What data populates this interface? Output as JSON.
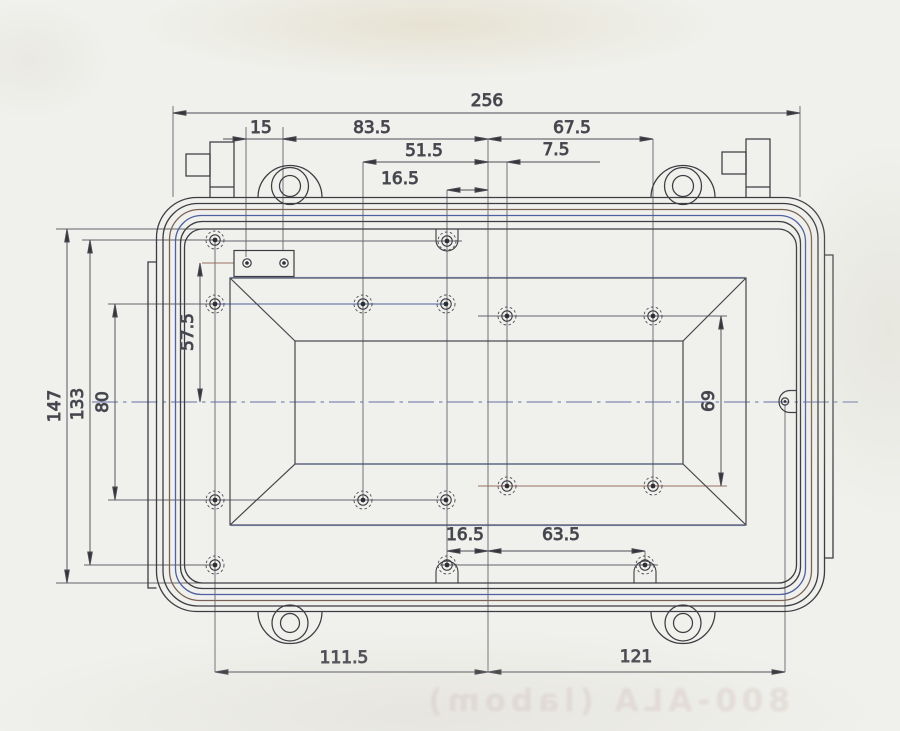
{
  "drawing": {
    "kind": "scanned engineering drawing",
    "view": "enclosure lid plan view",
    "units_implied": "mm"
  },
  "dimensions": {
    "overall_width": "256",
    "offset_15": "15",
    "span_83_5": "83.5",
    "span_67_5": "67.5",
    "span_51_5": "51.5",
    "offset_7_5": "7.5",
    "offset_16_5_top": "16.5",
    "height_147": "147",
    "height_133": "133",
    "height_80": "80",
    "height_57_5": "57.5",
    "height_69": "69",
    "offset_16_5_bottom": "16.5",
    "span_63_5": "63.5",
    "span_111_5": "111.5",
    "span_121": "121"
  },
  "bleed_through_text": "800-ALA (labom)",
  "colors": {
    "paper": "#f0f1ed",
    "ink": "#3c3c42",
    "dimension_ink": "#4d4d55",
    "construction_gray": "#63636b",
    "scan_tint_blue": "#5060a0",
    "scan_tint_sepia": "#97705e",
    "centerline_blue": "#6570a4"
  }
}
